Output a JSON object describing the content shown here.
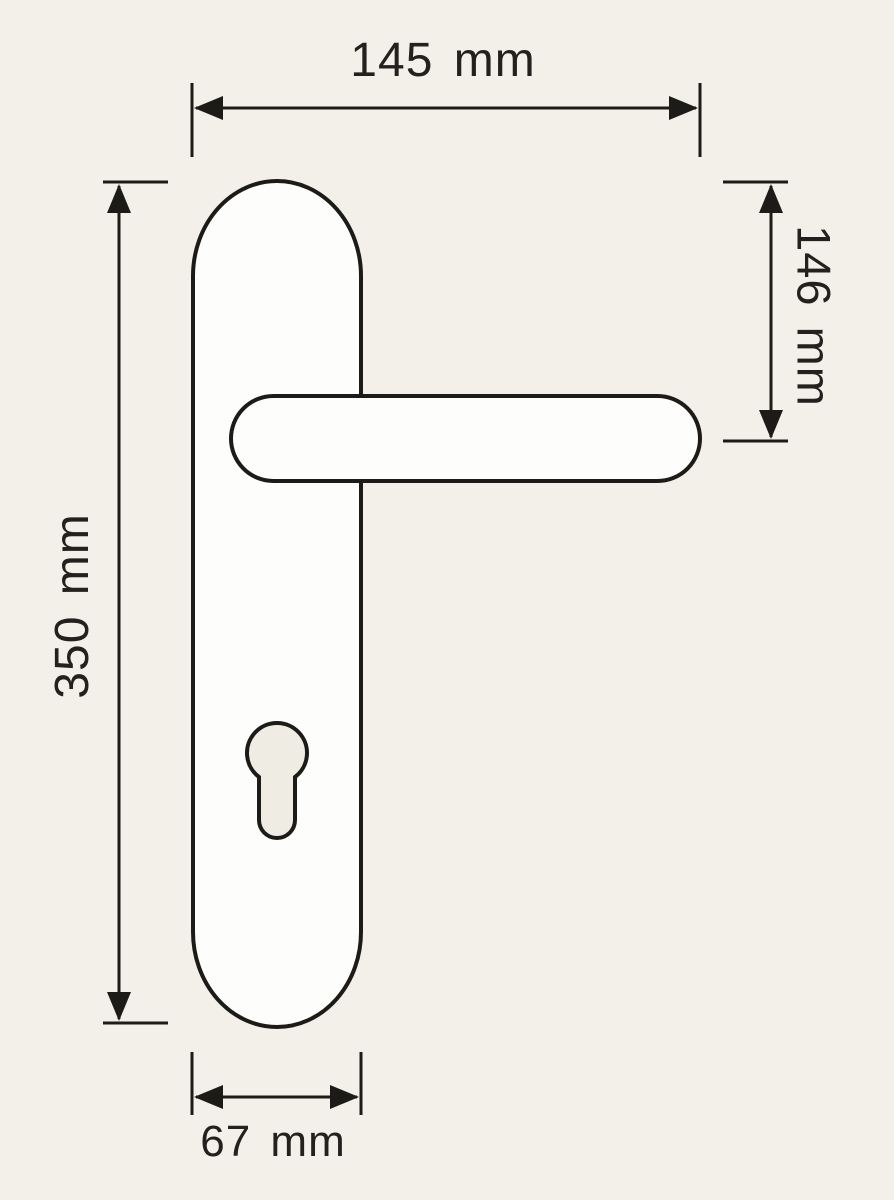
{
  "drawing": {
    "subject": "door-handle-with-backplate",
    "colors": {
      "background": "#f3efe9",
      "line": "#1d1b18",
      "shape_fill": "#fdfdfc",
      "keyhole_fill": "#efece4",
      "text": "#23201e"
    },
    "parts": {
      "backplate": "backplate",
      "lever": "lever-handle",
      "keyhole": "euro-profile-keyhole"
    },
    "dimensions": {
      "top": {
        "label": "145 mm",
        "value": 145,
        "unit": "mm",
        "orientation": "horizontal",
        "position": "top"
      },
      "right": {
        "label": "146 mm",
        "value": 146,
        "unit": "mm",
        "orientation": "vertical",
        "position": "right"
      },
      "left": {
        "label": "350 mm",
        "value": 350,
        "unit": "mm",
        "orientation": "vertical",
        "position": "left"
      },
      "bottom": {
        "label": "67 mm",
        "value": 67,
        "unit": "mm",
        "orientation": "horizontal",
        "position": "bottom"
      }
    }
  }
}
